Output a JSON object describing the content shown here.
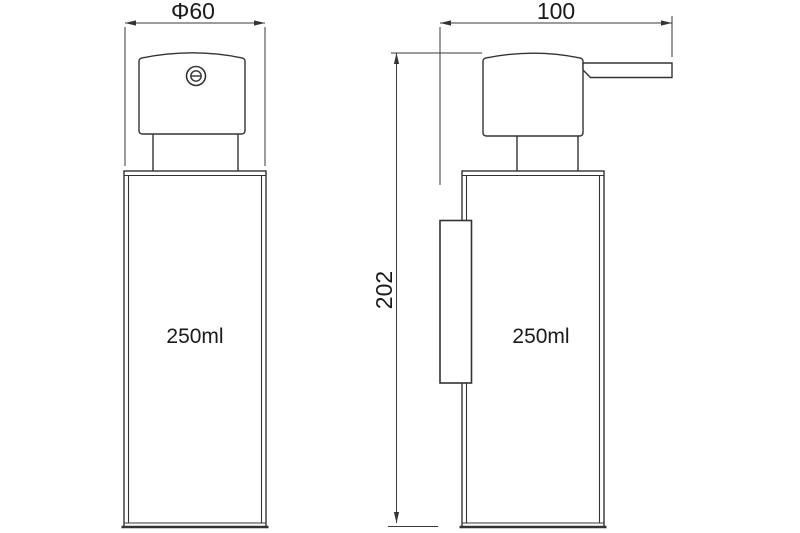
{
  "drawing": {
    "background_color": "#ffffff",
    "line_color": "#333333",
    "text_color": "#1a1a1a",
    "front_view": {
      "diameter_label": "Φ60",
      "capacity_label": "250ml"
    },
    "side_view": {
      "depth_label": "100",
      "height_label": "202",
      "capacity_label": "250ml"
    }
  }
}
